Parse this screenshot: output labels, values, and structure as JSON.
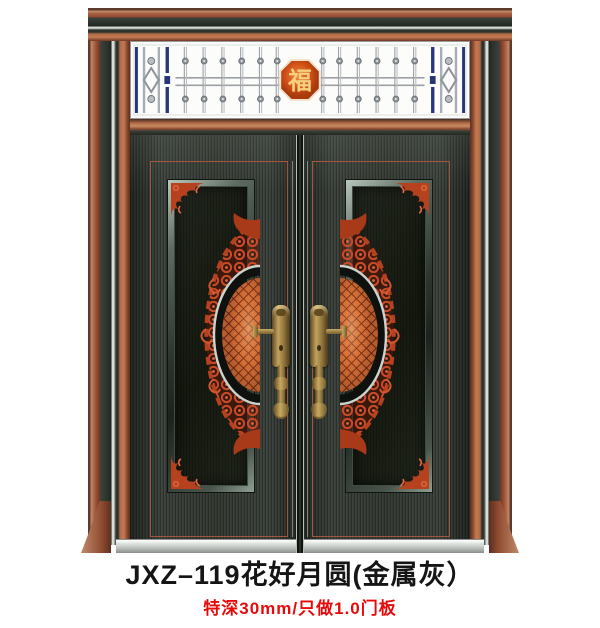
{
  "product": {
    "title": "JXZ–119花好月圆(金属灰）",
    "subtitle": "特深30mm/只做1.0门板",
    "title_color": "#151515",
    "subtitle_color": "#e60b0b"
  },
  "door": {
    "type": "double-leaf security door with transom window",
    "transom": {
      "medallion_char": "福",
      "medallion_fill": "#cf4a16",
      "medallion_rim": "#f3e2ce",
      "glass_color": "#fcfcfb",
      "accent_blue": "#27357a",
      "bar_color": "#9aa0a4"
    },
    "colors": {
      "frame_copper": "#a55a3d",
      "frame_dark": "#39413b",
      "frame_silver_line": "#ccd2cc",
      "leaf_metal_gray": "#333931",
      "panel_bevel_green": "#5d6b61",
      "ornament_red": "#c0452a",
      "mesh_copper": "#cf6a34",
      "chrome_arc": "#ccd3cf",
      "handle_brass": "#bb9c58",
      "threshold_steel": "#c9cdc9",
      "background": "#ffffff"
    }
  }
}
